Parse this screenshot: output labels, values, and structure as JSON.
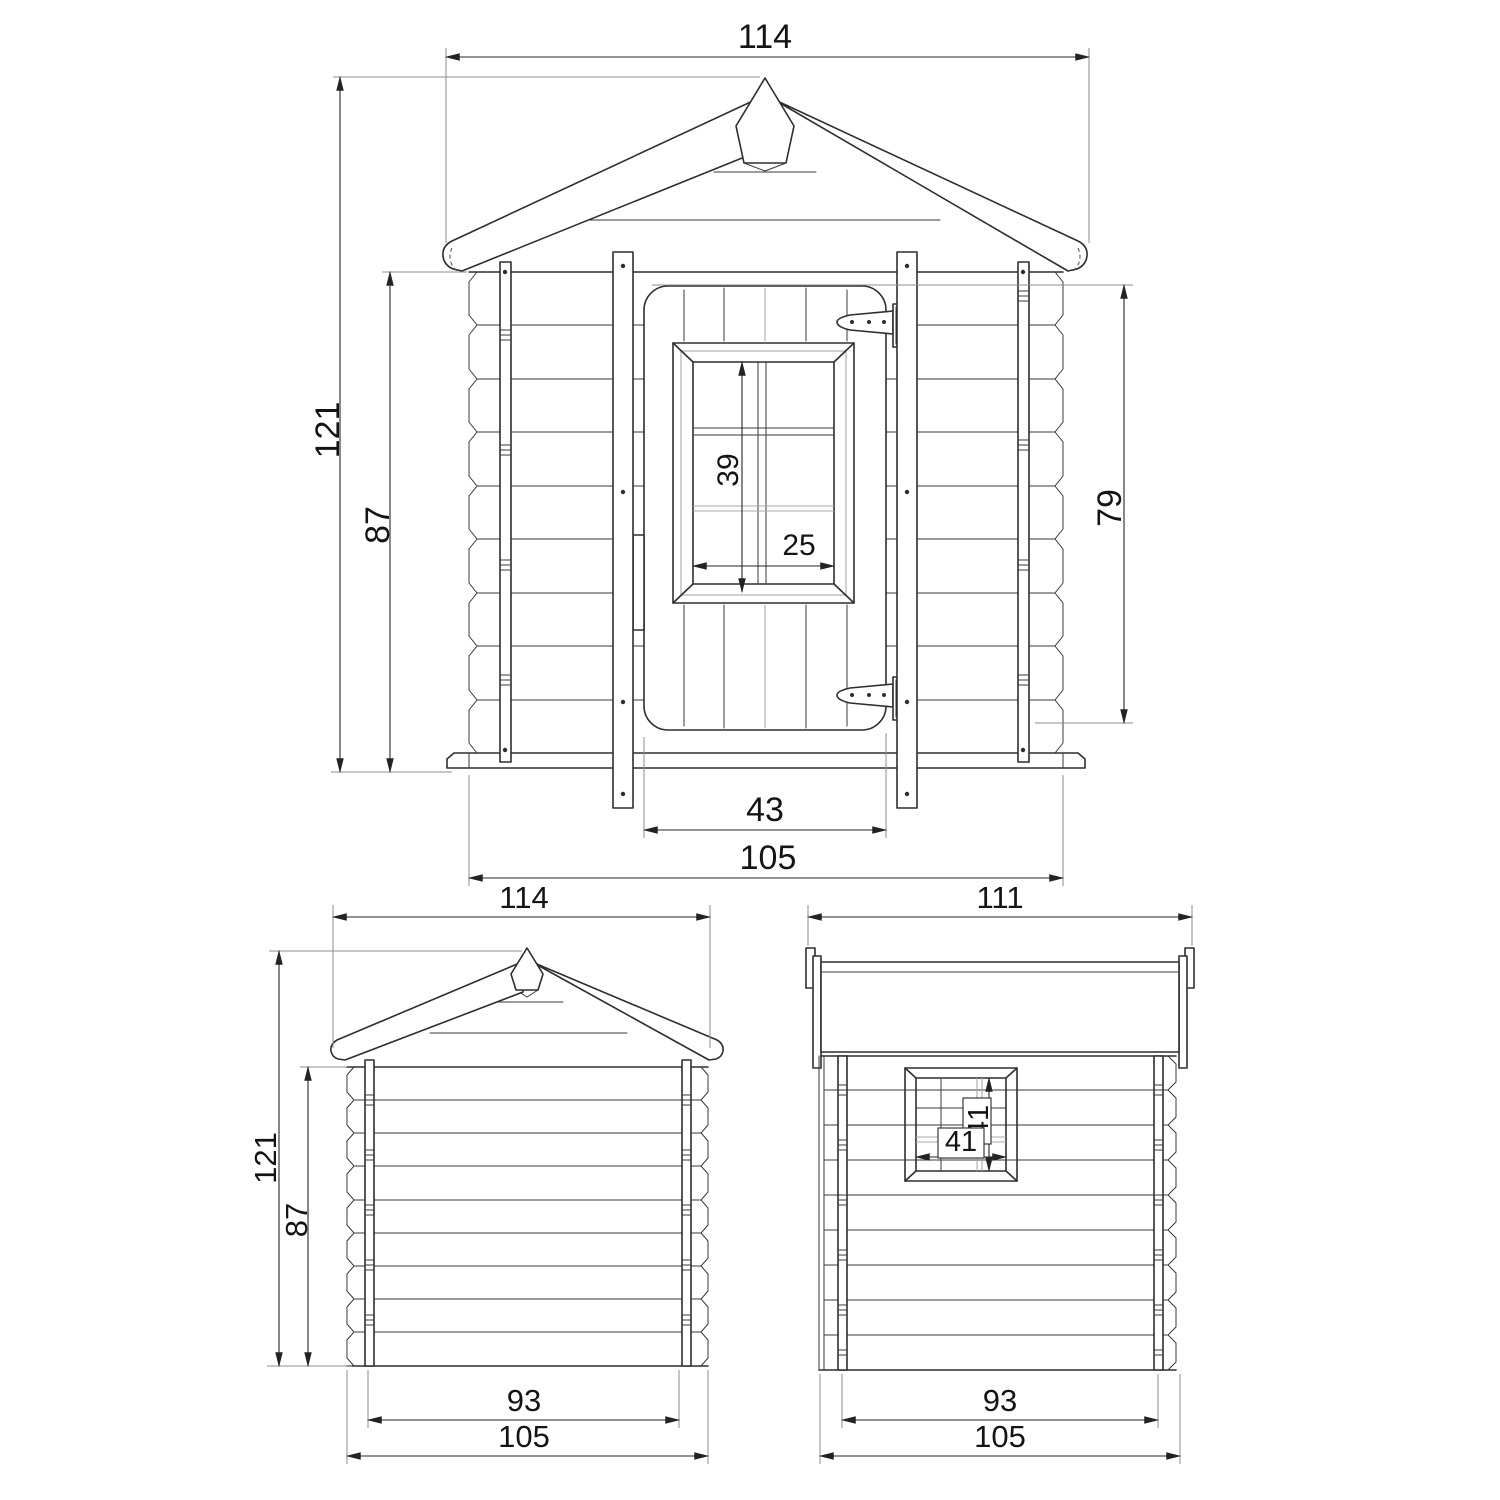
{
  "page": {
    "background_color": "#ffffff",
    "line_color": "#2e2e2e",
    "content": "wooden playhouse technical dimension drawing, three orthographic views"
  },
  "views": {
    "front": {
      "dims": {
        "roof_width": "114",
        "total_height": "121",
        "wall_height": "87",
        "door_opening_height": "79",
        "window_inner_height": "39",
        "window_inner_width": "25",
        "door_width": "43",
        "base_width": "105"
      }
    },
    "rear": {
      "dims": {
        "roof_width": "114",
        "total_height": "121",
        "wall_height": "87",
        "inner_base_width": "93",
        "base_width": "105"
      }
    },
    "side": {
      "dims": {
        "roof_depth": "111",
        "window_height": "41",
        "window_width": "41",
        "inner_base_depth": "93",
        "base_depth": "105"
      }
    }
  }
}
